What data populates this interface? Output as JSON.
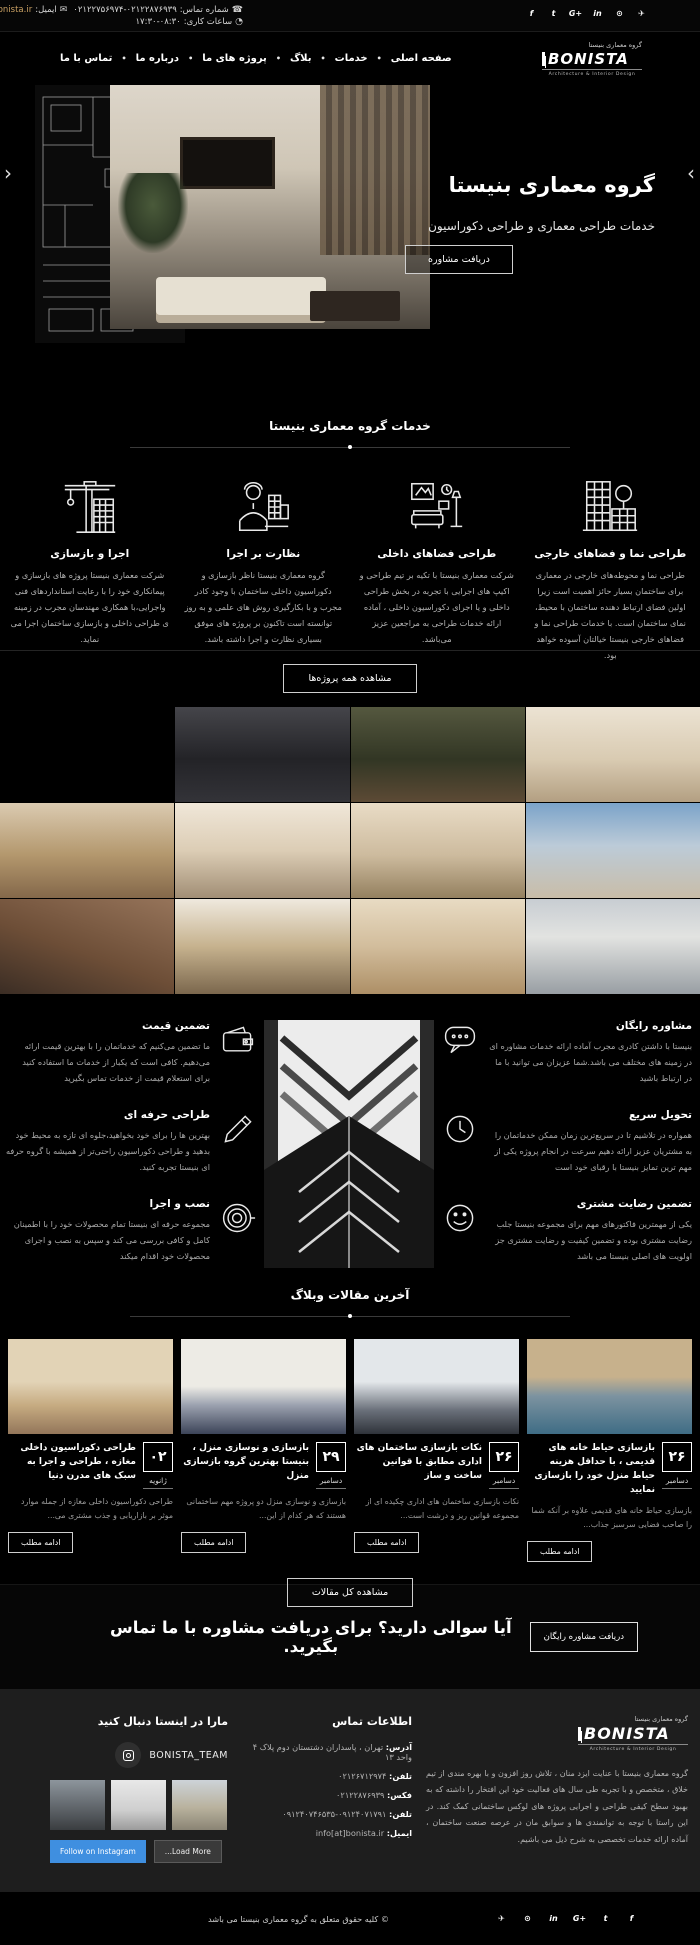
{
  "brand": {
    "name_fa": "گروه معماری بنیستا",
    "name_en": "BONISTA",
    "tagline": "Architecture & Interior Design"
  },
  "topbar": {
    "phone_label": "شماره تماس:",
    "phone_value": "۰۲۱۲۲۷۵۶۹۷۴-۰۲۱۲۲۸۷۶۹۳۹",
    "email_label": "ایمیل:",
    "email_value": "info@bonista.ir",
    "hours_label": "ساعات کاری:",
    "hours_value": "۱۷:۳۰-۰۸:۳۰",
    "socials": [
      {
        "name": "facebook",
        "glyph": "f"
      },
      {
        "name": "twitter",
        "glyph": "t"
      },
      {
        "name": "google-plus",
        "glyph": "G+"
      },
      {
        "name": "linkedin",
        "glyph": "in"
      },
      {
        "name": "instagram",
        "glyph": "⊙"
      },
      {
        "name": "telegram",
        "glyph": "✈"
      }
    ]
  },
  "nav": {
    "items": [
      "صفحه اصلی",
      "خدمات",
      "بلاگ",
      "پروژه های ما",
      "درباره ما",
      "تماس با ما"
    ]
  },
  "hero": {
    "title": "گروه معماری بنیستا",
    "subtitle": "خدمات طراحی معماری و طراحی دکوراسیون",
    "cta": "دریافت مشاوره",
    "prev": "‹",
    "next": "›"
  },
  "services": {
    "heading": "خدمات گروه معماری بنیستا",
    "items": [
      {
        "title": "طراحی نما و فضاهای خارجی",
        "text": "طراحی نما و محوطه‌های خارجی در معماری برای ساختمان بسیار حائز اهمیت است زیرا اولین فضای ارتباط دهنده ساختمان با محیط، نمای ساختمان است. با خدمات طراحی نما و فضاهای خارجی بنیستا خیالتان آسوده خواهد بود."
      },
      {
        "title": "طراحی فضاهای داخلی",
        "text": "شرکت معماری بنیستا با تکیه بر تیم طراحی و اکیپ های اجرایی با تجربه در بخش طراحی داخلی و یا اجرای دکوراسیون داخلی ، آماده ارائه خدمات طراحی به مراجعین عزیز می‌باشد."
      },
      {
        "title": "نظارت بر اجرا",
        "text": "گروه معماری بنیستا ناظر بازسازی و دکوراسیون داخلی ساختمان با وجود کادر مجرب و با بکارگیری روش های علمی و به روز توانسته است تاکنون بر پروژه های موفق بسیاری نظارت و اجرا داشته باشد."
      },
      {
        "title": "اجرا و بازسازی",
        "text": "شرکت معماری بنیستا پروژه های بازسازی و پیمانکاری خود را با رعایت استانداردهای فنی واجرایی،با همکاری مهندسان مجرب در زمینه ی طراحی داخلی و بازسازی ساختمان اجرا می نماید."
      }
    ]
  },
  "projects": {
    "view_all": "مشاهده همه پروژه‌ها",
    "items": [
      {
        "desc": "classic hallway interior",
        "style": "background:linear-gradient(180deg,#ece3d3,#d9cbb2 55%,#b39f82)"
      },
      {
        "desc": "restaurant greenhouse interior",
        "style": "background:linear-gradient(180deg,#55583f,#323624 55%,#5c4a35)"
      },
      {
        "desc": "gym interior columbia",
        "style": "background:linear-gradient(180deg,#45454a,#232327 55%,#333338)"
      },
      {
        "desc": "classic building facade with sky",
        "style": "background:linear-gradient(180deg,#7ba3c9,#bccbd8 45%,#c9bda8)"
      },
      {
        "desc": "classic dining room with chandelier",
        "style": "background:linear-gradient(180deg,#e9dcc6,#cdbb9e 55%,#94805f)"
      },
      {
        "desc": "classic living room and kitchen",
        "style": "background:linear-gradient(180deg,#f0e7d9,#dccdb5 50%,#a18e75)"
      },
      {
        "desc": "wooden kitchen interior",
        "style": "background:linear-gradient(180deg,#dbcbb1,#b3976d 55%,#84684a)"
      },
      {
        "desc": "modern white building facade",
        "style": "background:linear-gradient(180deg,#c8cdd2,#e2e3e1 40%,#989ea3)"
      },
      {
        "desc": "luxury classic living room",
        "style": "background:linear-gradient(180deg,#e8dbc3,#d2bd9c 50%,#ad8f66)"
      },
      {
        "desc": "wooden ceiling design",
        "style": "background:linear-gradient(180deg,#efe9de,#c6b28e 50%,#7b674d)"
      },
      {
        "desc": "brick facade at sunset",
        "style": "background:linear-gradient(200deg,#96745a,#6d4e37 55%,#3b2d24)"
      }
    ]
  },
  "features": {
    "right": [
      {
        "title": "مشاوره رایگان",
        "text": "بنیستا با داشتن کادری مجرب آماده ارائه خدمات مشاوره ای در زمینه های مختلف می باشد.شما عزیزان می توانید با ما در ارتباط باشید"
      },
      {
        "title": "تحویل سریع",
        "text": "همواره در تلاشیم تا در سریع‌ترین زمان ممکن خدماتمان را به مشتریان عزیز ارائه دهیم سرعت در انجام پروژه یکی از مهم ترین تمایز بنیستا با رقبای خود است"
      },
      {
        "title": "تضمین رضایت مشتری",
        "text": "یکی از مهمترین فاکتورهای مهم برای مجموعه بنیستا جلب رضایت مشتری بوده و تضمین کیفیت و رضایت مشتری جز اولویت های اصلی بنیستا می باشد"
      }
    ],
    "left": [
      {
        "title": "تضمین قیمت",
        "text": "ما تضمین می‌کنیم که خدماتمان را با بهترین قیمت ارائه می‌دهیم. کافی است که یکبار از خدمات ما استفاده کنید برای استعلام قیمت از خدمات تماس بگیرید"
      },
      {
        "title": "طراحی حرفه ای",
        "text": "بهترین ها را برای خود بخواهید،جلوه ای تازه به محیط خود بدهید و طراحی دکوراسیون راحتی‌تر از همیشه با گروه حرفه ای بنیستا تجربه کنید."
      },
      {
        "title": "نصب و اجرا",
        "text": "مجموعه حرفه ای بنیستا تمام محصولات خود را با اطمینان کامل و کافی بررسی می کند و سپس به نصب و اجرای محصولات خود اقدام میکند"
      }
    ],
    "center_image_desc": "black and white architectural building corner"
  },
  "blog": {
    "heading": "آخرین مقالات وبلاگ",
    "read_more": "ادامه مطلب",
    "view_all": "مشاهده کل مقالات",
    "posts": [
      {
        "day": "۲۶",
        "month": "دسامبر",
        "title": "بازسازی حیاط خانه های قدیمی ، با حداقل هزینه حیاط منزل خود را بازسازی نمایید",
        "excerpt": "بازسازی حیاط خانه های قدیمی علاوه بر آنکه شما را صاحب فضایی سرسبز جذاب...",
        "style": "background:linear-gradient(180deg,#c7b18c 40%,#7c93a0 60%,#3f6d85)"
      },
      {
        "day": "۲۶",
        "month": "دسامبر",
        "title": "نکات بازسازی ساختمان های اداری مطابق با قوانین ساخت و ساز",
        "excerpt": "نکات بازسازی ساختمان های اداری چکیده ای از مجموعه قوانین ریز و درشت است...",
        "style": "background:linear-gradient(180deg,#e3e7ea 45%,#6a707a 75%,#2f333a)"
      },
      {
        "day": "۲۹",
        "month": "دسامبر",
        "title": "بازسازی و نوسازی منزل ، بنیستا بهترین گروه بازسازی منزل",
        "excerpt": "بازسازی و نوسازی منزل دو پروژه مهم ساختمانی هستند که هر کدام از این...",
        "style": "background:linear-gradient(180deg,#edebe5 50%,#9aa0ae 70%,#3c4458)"
      },
      {
        "day": "۰۲",
        "month": "ژانویه",
        "title": "طراحی دکوراسیون داخلی مغازه ، طراحی و اجرا به سبک های مدرن دنیا",
        "excerpt": "طراحی دکوراسیون داخلی مغازه از جمله موارد موثر بر بازاریابی و جذب مشتری می...",
        "style": "background:linear-gradient(180deg,#e2d3b6 45%,#c6ab81 70%,#93765a)"
      }
    ]
  },
  "cta": {
    "text": "آیا سوالی دارید؟ برای دریافت مشاوره با ما تماس بگیرید.",
    "button": "دریافت مشاوره رایگان"
  },
  "footer": {
    "about": "گروه معماری بنیستا با عنایت ایزد منان ، تلاش روز افزون و با بهره مندی از تیم خلاق ، متخصص و با تجربه طی سال های فعالیت خود این افتخار را داشته که به بهبود سطح کیفی طراحی و اجرایی پروژه های لوکس ساختمانی کمک کند. در این راستا با توجه به توانمندی ها و سوابق مان در عرصه صنعت ساختمان ، آماده ارائه خدمات تخصصی به شرح ذیل می باشیم.",
    "contact_heading": "اطلاعات تماس",
    "contact": [
      {
        "label": "آدرس:",
        "value": "تهران ، پاسداران دشتستان دوم پلاک ۴ واحد ۱۳"
      },
      {
        "label": "تلفن:",
        "value": "۰۲۱۲۶۷۱۲۹۷۴"
      },
      {
        "label": "فکس:",
        "value": "۰۲۱۲۲۸۷۶۹۳۹"
      },
      {
        "label": "تلفن:",
        "value": "۰۹۱۲۴۰۷۱۷۹۱-۰۹۱۲۴۰۷۴۶۵۳۵"
      },
      {
        "label": "ایمیل:",
        "value": "info[at]bonista.ir"
      }
    ],
    "follow_heading": "مارا در اینستا دنبال کنید",
    "insta_account": "BONISTA_TEAM",
    "follow_button": "Follow on Instagram",
    "load_more": "...Load More",
    "insta_thumbs": [
      {
        "desc": "building photo",
        "style": "background:linear-gradient(180deg,#8d959c,#5c6166 60%,#3a3d40)"
      },
      {
        "desc": "architecture sketch",
        "style": "background:linear-gradient(180deg,#e8e8e8,#cfcfcf 60%,#9b9b9b)"
      },
      {
        "desc": "apartment building",
        "style": "background:linear-gradient(180deg,#cdd3d8,#b9b29e 55%,#8a8474)"
      }
    ]
  },
  "bottombar": {
    "copyright": "© کلیه حقوق متعلق به گروه معماری بنیستا می باشد",
    "socials": [
      {
        "name": "telegram",
        "glyph": "✈"
      },
      {
        "name": "instagram",
        "glyph": "⊙"
      },
      {
        "name": "linkedin",
        "glyph": "in"
      },
      {
        "name": "google-plus",
        "glyph": "G+"
      },
      {
        "name": "twitter",
        "glyph": "t"
      },
      {
        "name": "facebook",
        "glyph": "f"
      }
    ]
  }
}
